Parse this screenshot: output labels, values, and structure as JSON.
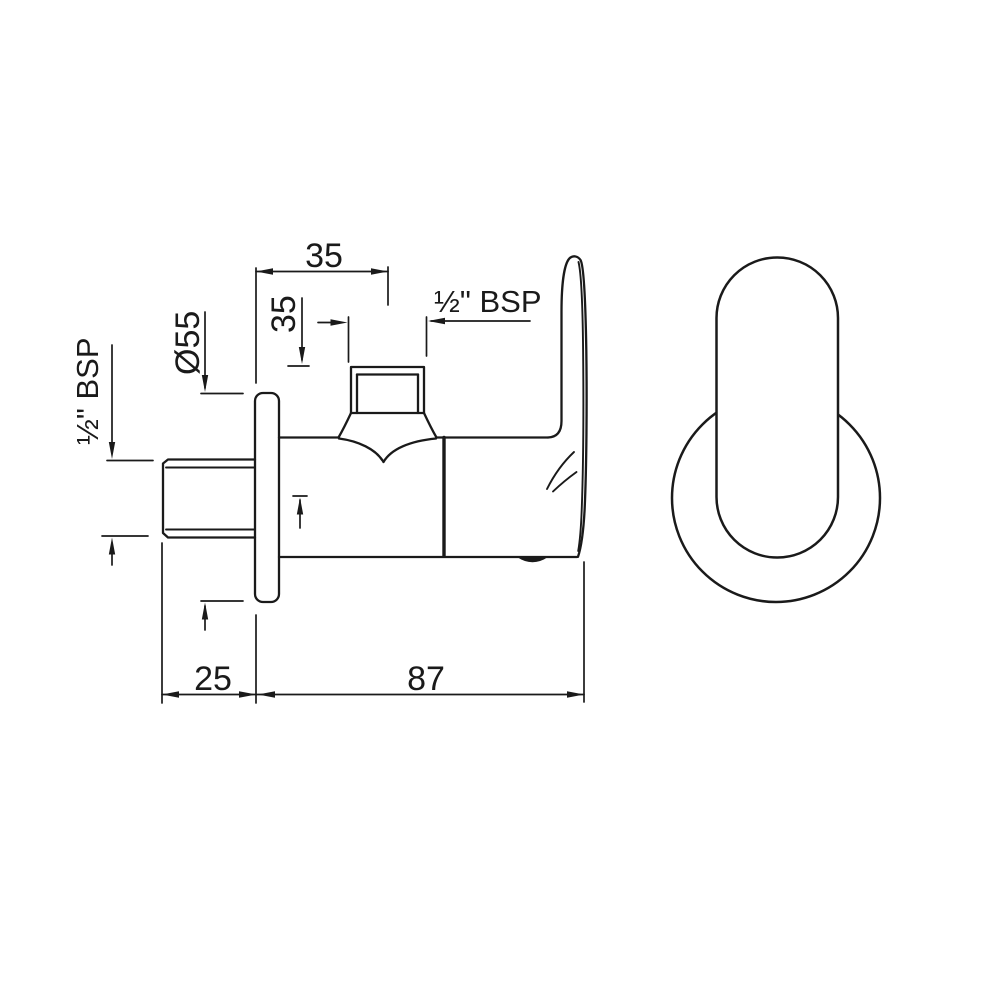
{
  "drawing": {
    "line_color": "#1a1a1a",
    "background": "#ffffff",
    "views": {
      "side_view": "side elevation of angle valve",
      "front_view": "front elevation of flange and lever"
    },
    "dimensions": {
      "wall_to_spindle_axis": "35",
      "outlet_face_to_inlet_axis": "35",
      "flange_diameter": "Ø55",
      "outlet_thread": "½\" BSP",
      "inlet_thread": "½\" BSP",
      "inlet_projection": "25",
      "flange_to_handle_length": "87"
    }
  }
}
